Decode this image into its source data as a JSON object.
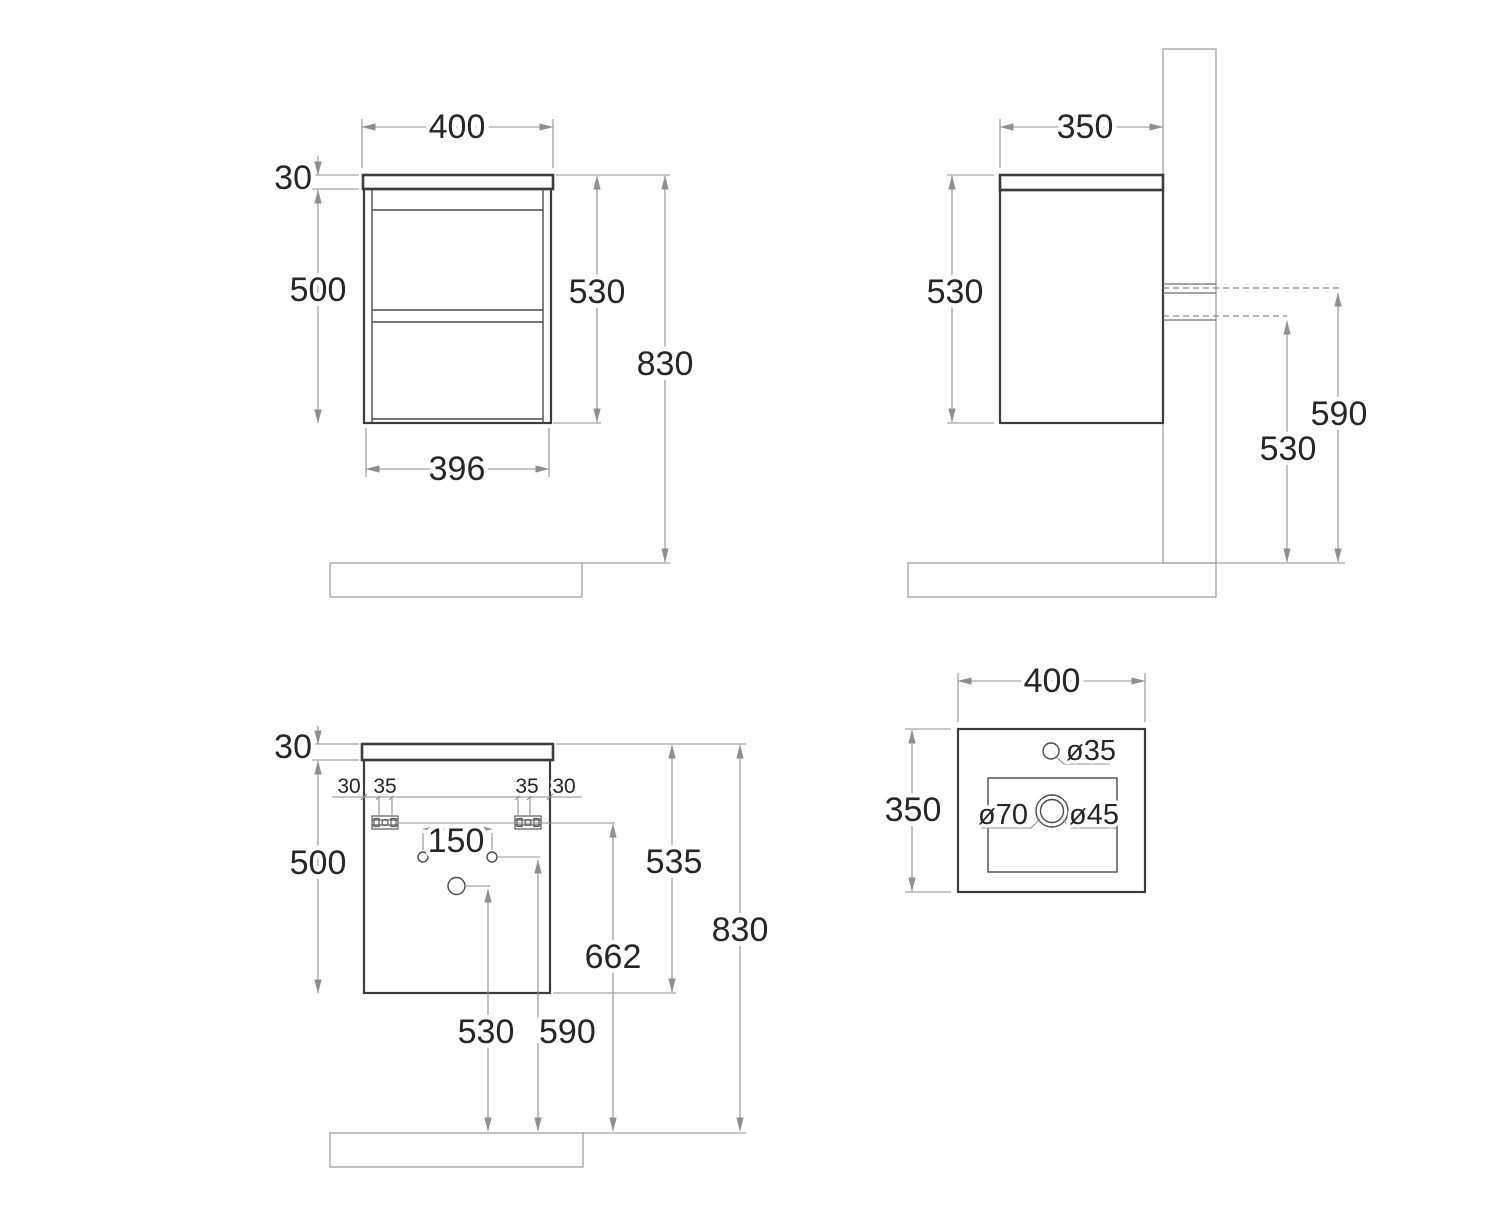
{
  "drawing": {
    "type": "technical-drawing",
    "subject": "wall-hung vanity cabinet with washbasin, dimensioned views (mm)",
    "colors": {
      "outline": "#3c3c3c",
      "dimension": "#8f8f8f",
      "hatch": "#a8a8a8",
      "text": "#262626",
      "background": "#ffffff"
    }
  },
  "front": {
    "width": "400",
    "top_thickness": "30",
    "body_height": "500",
    "cabinet_height": "530",
    "total_height": "830",
    "bottom_width": "396"
  },
  "side": {
    "depth": "350",
    "height": "530",
    "upper_rail_height": "590",
    "lower_rail_height": "530"
  },
  "back": {
    "top_thickness": "30",
    "left_offset": "30",
    "left_bracket": "35",
    "right_bracket": "35",
    "right_offset": "30",
    "hole_spacing": "150",
    "body_height": "500",
    "cabinet_height": "535",
    "rail_floor_height": "662",
    "total_height": "830",
    "drain_floor_height": "530",
    "holes_floor_height": "590"
  },
  "sink": {
    "width": "400",
    "depth": "350",
    "faucet_hole": "ø35",
    "overflow": "ø70",
    "drain": "ø45"
  }
}
